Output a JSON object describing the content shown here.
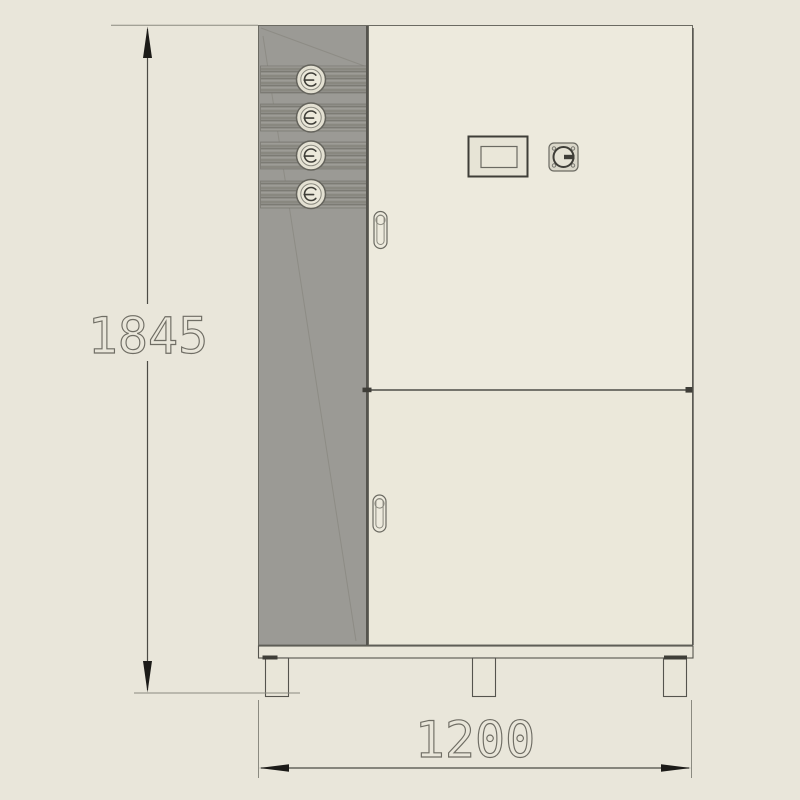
{
  "drawing": {
    "kind": "cabinet-front-elevation",
    "dimensions": {
      "height": {
        "label": "1845"
      },
      "width": {
        "label": "1200"
      }
    },
    "components": {
      "pipe_connectors": 4,
      "doors": 2,
      "feet": 3
    },
    "colors": {
      "background": "#e9e6da",
      "panel_gray": "#9b9a95",
      "panel_edge": "#55544e",
      "strip_dark": "#7c7b74",
      "door_face": "#edeadd",
      "door_face_lower": "#ebe8da",
      "divider": "#75746c",
      "outline": "#6b6a62",
      "outline_dark": "#3f3e38",
      "base_fill": "#e9e6d9",
      "connector_ring": "#e3e0d2",
      "connector_face": "#ece9db",
      "dim_line": "#4c4b45",
      "ext_line": "#8b8a80",
      "arrow": "#1c1b18",
      "dim_text": "#6f6d64"
    }
  }
}
